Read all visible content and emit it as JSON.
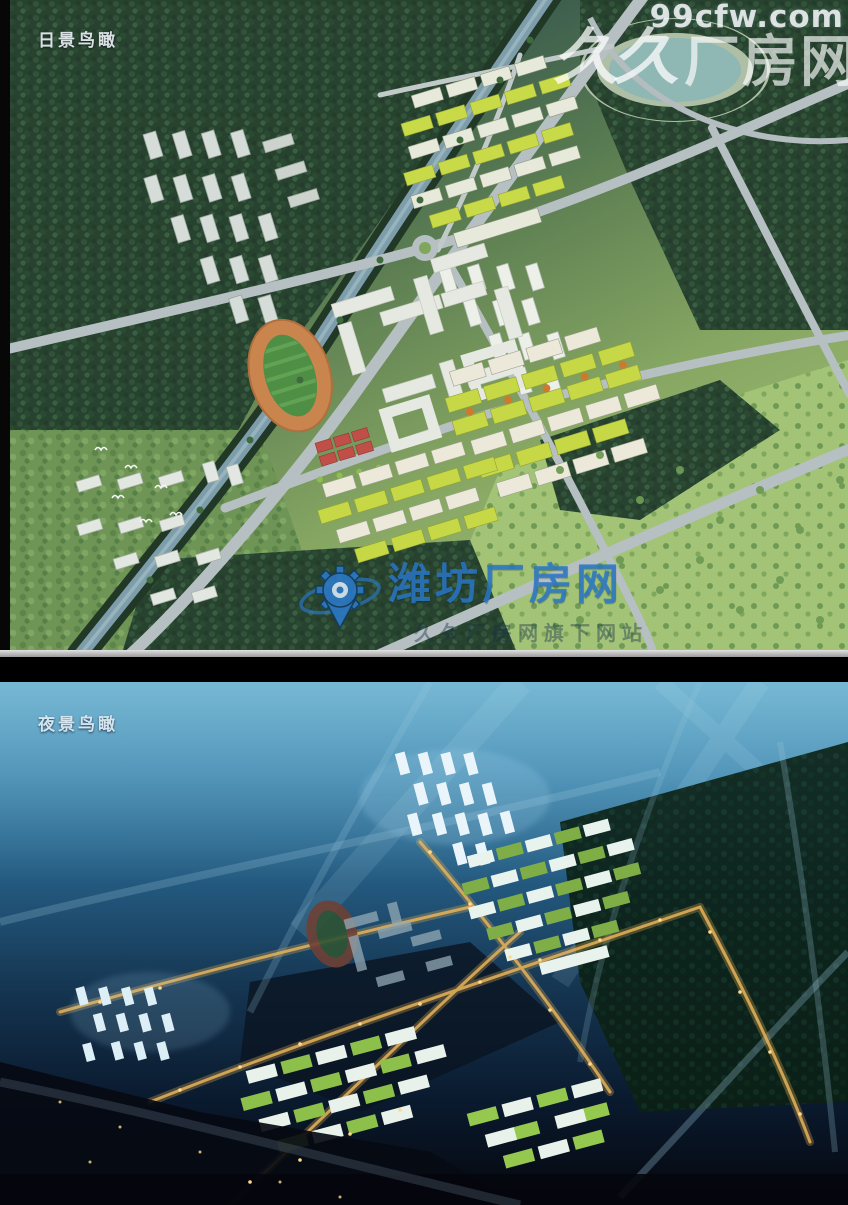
{
  "panels": {
    "day": {
      "label": "日景鸟瞰"
    },
    "night": {
      "label": "夜景鸟瞰"
    }
  },
  "watermarks": {
    "corner": {
      "url": "99cfw.com",
      "logo_glyphs": "久久",
      "brand": "厂房网"
    },
    "center": {
      "brand": "潍坊厂房网",
      "slogan": "久久厂房网旗下网站",
      "logo_icon": "gear-location-pin",
      "accent_color": "#2b7aca"
    }
  },
  "scene_palette": {
    "day_roof_green": "#c6d845",
    "day_track_orange": "#c9854d",
    "court_red": "#bf4f47",
    "night_sky_blue": "#3d85ad",
    "night_light_amber": "#d9a84e"
  }
}
